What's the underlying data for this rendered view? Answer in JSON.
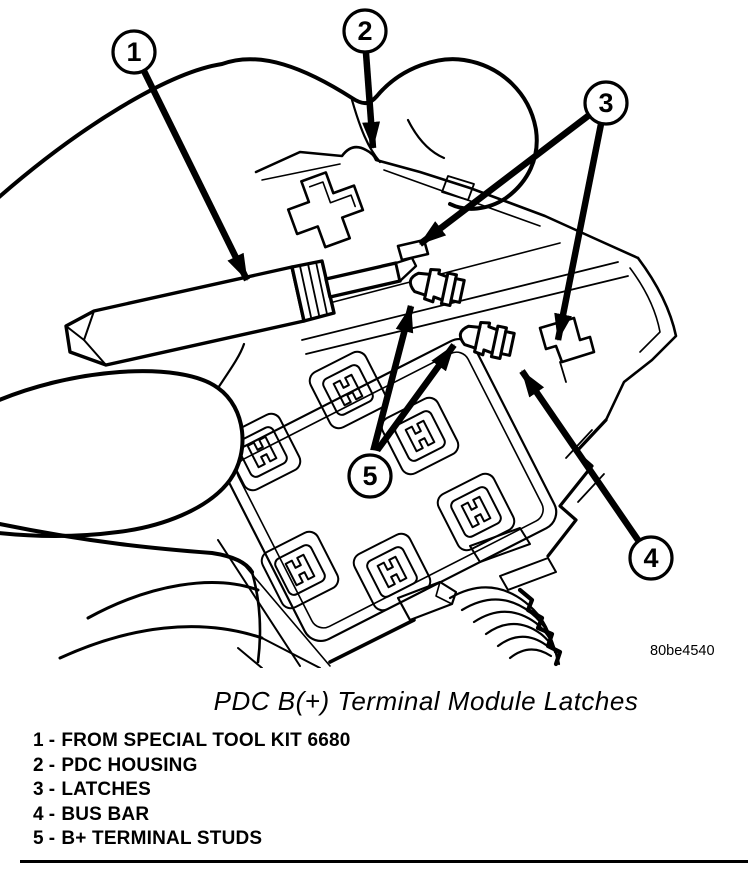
{
  "page": {
    "background": "#ffffff",
    "ink": "#000000"
  },
  "figure": {
    "caption": "PDC B(+) Terminal Module Latches",
    "code": "80be4540",
    "callouts": [
      {
        "number": "1"
      },
      {
        "number": "2"
      },
      {
        "number": "3"
      },
      {
        "number": "4"
      },
      {
        "number": "5"
      }
    ]
  },
  "legend": {
    "items": [
      {
        "number": "1",
        "separator": "-",
        "label": "FROM SPECIAL TOOL KIT 6680"
      },
      {
        "number": "2",
        "separator": "-",
        "label": "PDC HOUSING"
      },
      {
        "number": "3",
        "separator": "-",
        "label": "LATCHES"
      },
      {
        "number": "4",
        "separator": "-",
        "label": "BUS BAR"
      },
      {
        "number": "5",
        "separator": "-",
        "label": "B+ TERMINAL STUDS"
      }
    ]
  }
}
